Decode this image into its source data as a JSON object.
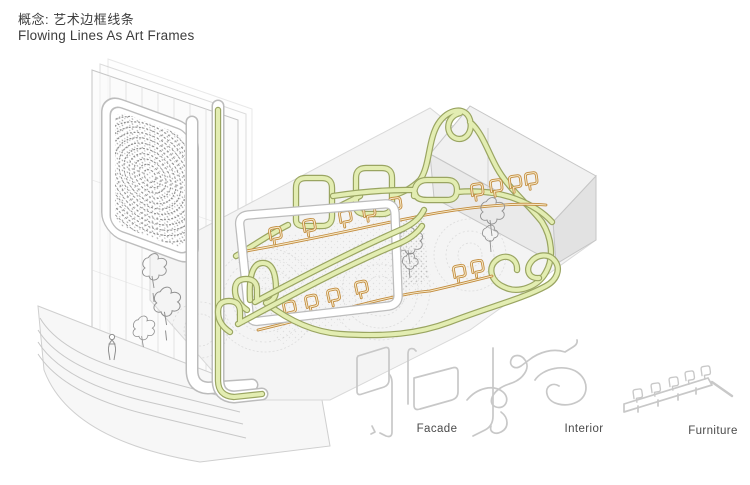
{
  "page": {
    "title_zh": "概念: 艺术边框线条",
    "title_en": "Flowing Lines As Art Frames"
  },
  "legend": {
    "items": [
      {
        "label": "Facade"
      },
      {
        "label": "Interior"
      },
      {
        "label": "Furniture"
      }
    ]
  },
  "colors": {
    "green_stroke": "#9aa562",
    "green_fill": "#e3edb2",
    "orange_stroke": "#c18a3c",
    "orange_fill": "#f6e9c8",
    "gray_line": "#c8c8c8",
    "text": "#3d3d3d"
  }
}
